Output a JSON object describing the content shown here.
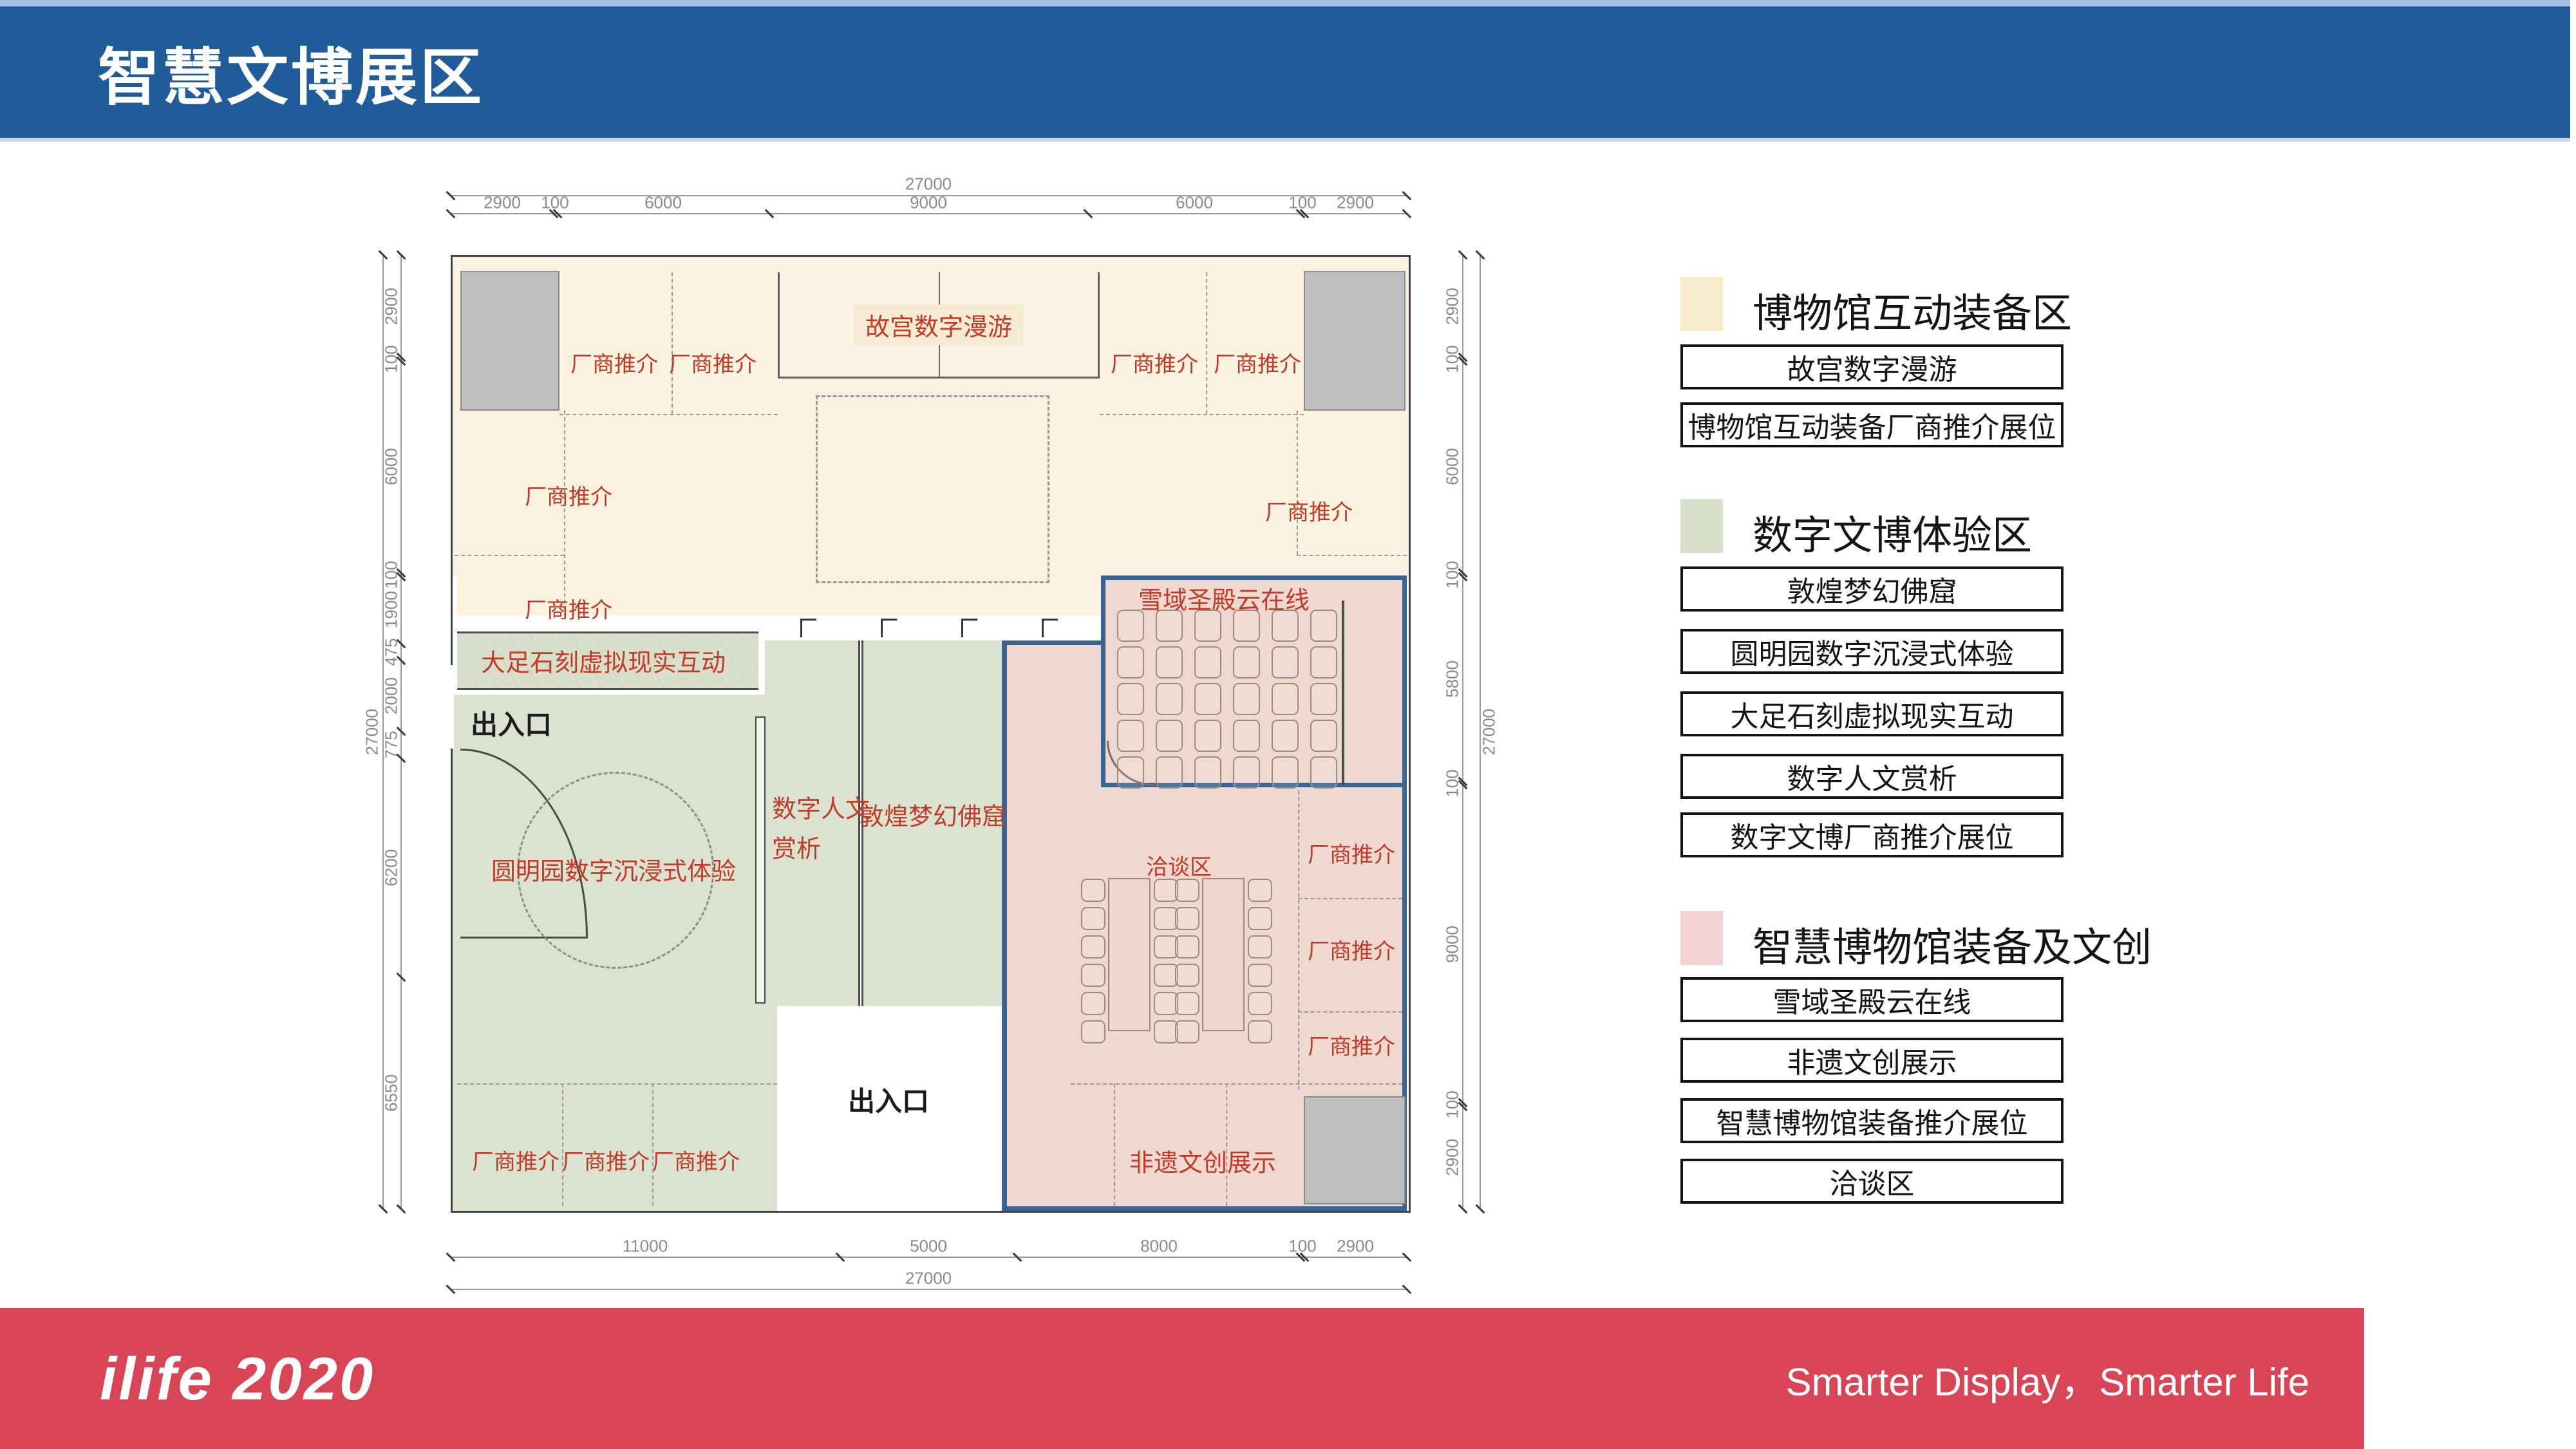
{
  "header": {
    "title": "智慧文博展区",
    "bg_color": "#1F5C99"
  },
  "footer": {
    "logo": "ilife 2020",
    "slogan": "Smarter Display，Smarter Life",
    "bg_color": "#D84556"
  },
  "legend": {
    "sections": [
      {
        "swatch_color": "#F6ECCB",
        "title": "博物馆互动装备区",
        "items": [
          "故宫数字漫游",
          "博物馆互动装备厂商推介展位"
        ]
      },
      {
        "swatch_color": "#D8E0CA",
        "title": "数字文博体验区",
        "items": [
          "敦煌梦幻佛窟",
          "圆明园数字沉浸式体验",
          "大足石刻虚拟现实互动",
          "数字人文赏析",
          "数字文博厂商推介展位"
        ]
      },
      {
        "swatch_color": "#F2D2D3",
        "title": "智慧博物馆装备及文创",
        "items": [
          "雪域圣殿云在线",
          "非遗文创展示",
          "智慧博物馆装备推介展位",
          "洽谈区"
        ]
      }
    ]
  },
  "plan": {
    "zone_colors": {
      "museum_interactive": "#FAF1DE",
      "digital_experience": "#DBE2D0",
      "smart_equipment": "#EFD8D0"
    },
    "labels": {
      "vendor_booth": "厂商推介",
      "entrance": "出入口",
      "gugong": "故宫数字漫游",
      "dazu": "大足石刻虚拟现实互动",
      "yuanmingyuan": "圆明园数字沉浸式体验",
      "renwen_line1": "数字人文",
      "renwen_line2": "赏析",
      "dunhuang": "敦煌梦幻佛窟",
      "xueyu": "雪域圣殿云在线",
      "qiatan": "洽谈区",
      "feiyi": "非遗文创展示"
    }
  },
  "dimensions": {
    "top": {
      "total": "27000",
      "segments": [
        "2900",
        "100",
        "6000",
        "9000",
        "6000",
        "100",
        "2900"
      ]
    },
    "bottom": {
      "total": "27000",
      "segments": [
        "11000",
        "5000",
        "8000",
        "100",
        "2900"
      ]
    },
    "left": {
      "total": "27000",
      "segments": [
        "2900",
        "100",
        "6000",
        "100",
        "1900",
        "475",
        "2000",
        "775",
        "6200",
        "6550"
      ]
    },
    "right": {
      "total": "27000",
      "segments": [
        "2900",
        "100",
        "6000",
        "100",
        "5800",
        "100",
        "9000",
        "100",
        "2900"
      ]
    }
  }
}
